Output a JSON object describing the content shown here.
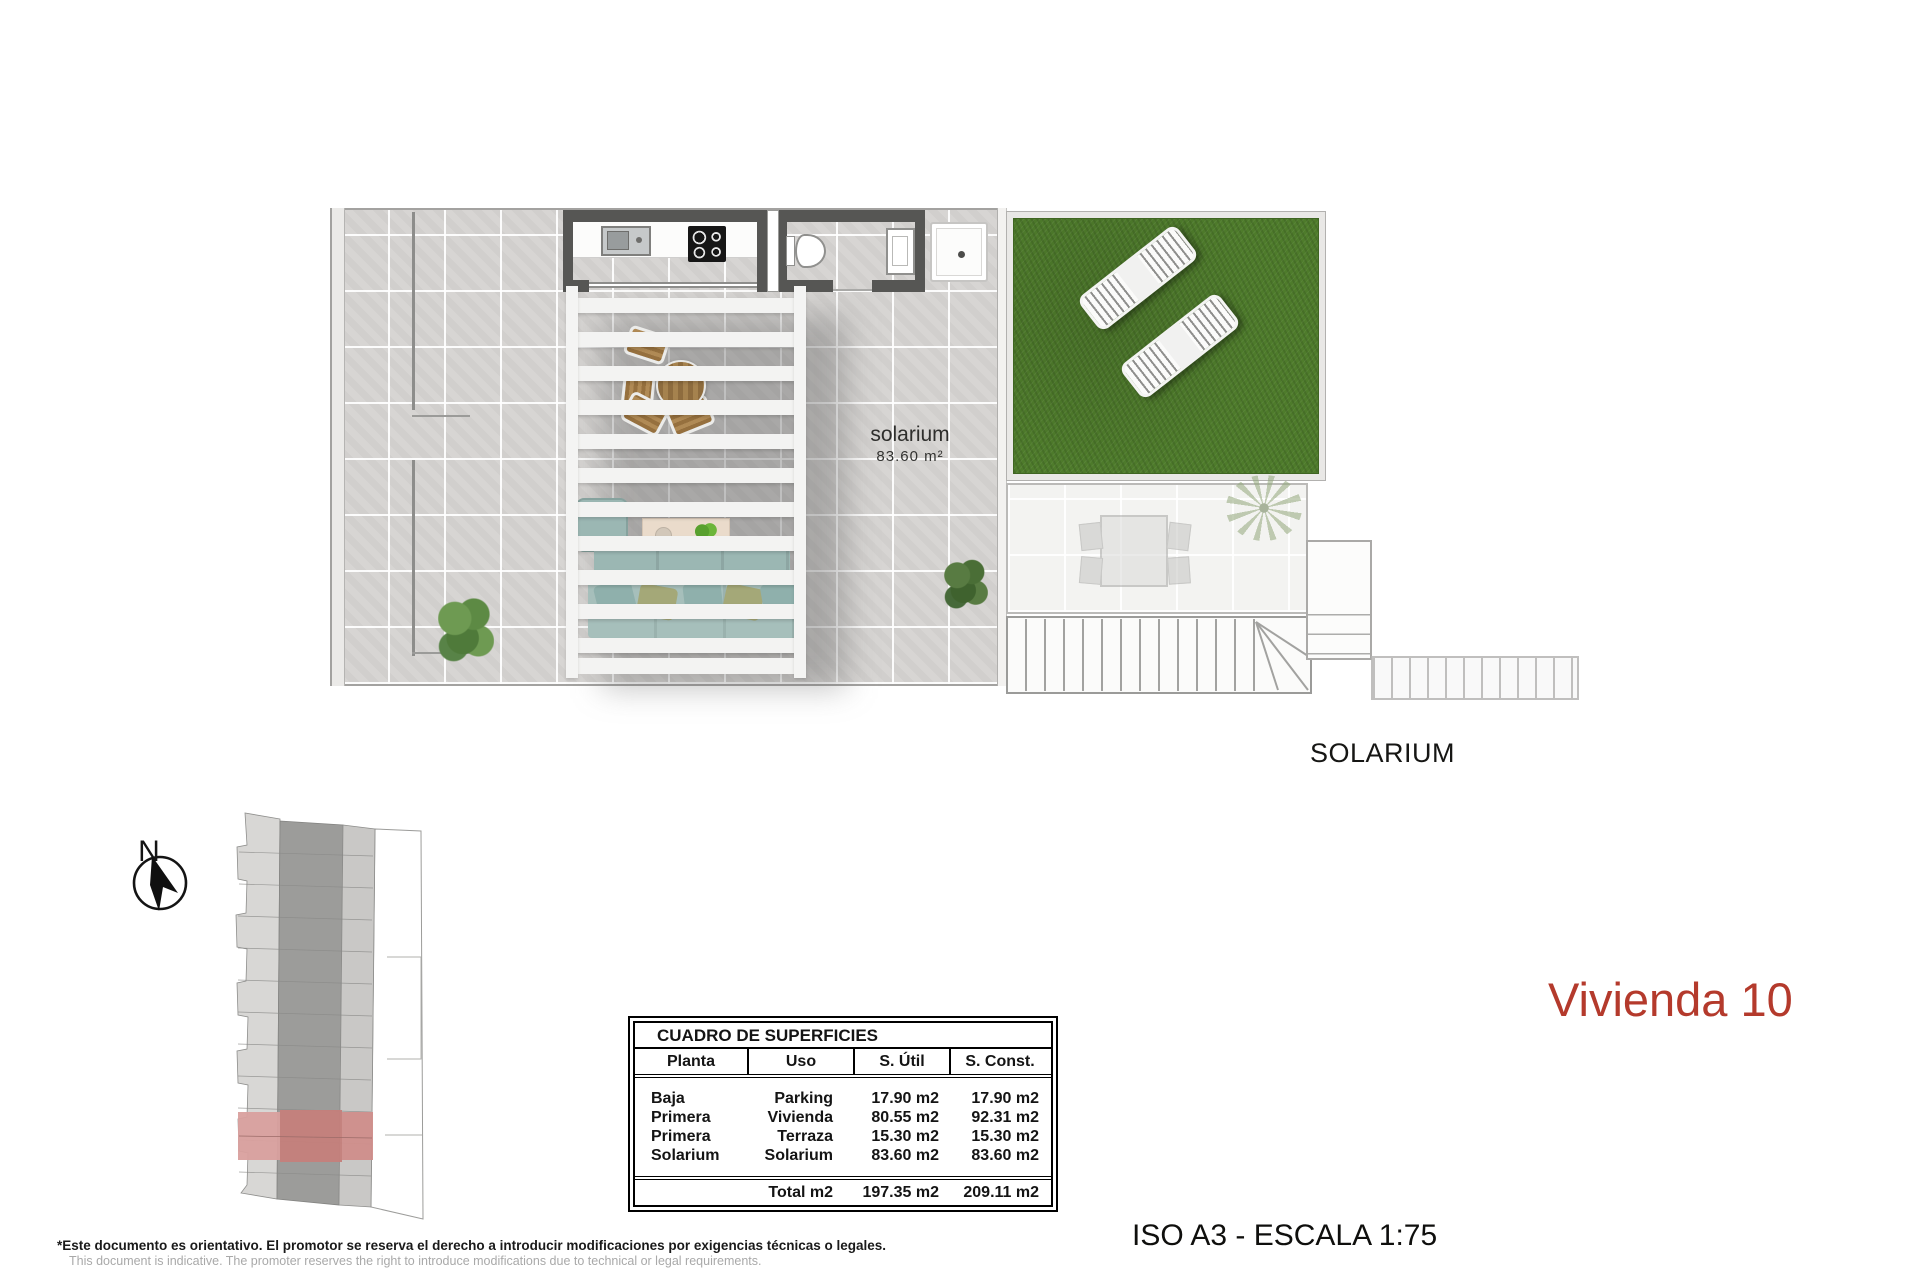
{
  "plan": {
    "room_label": "solarium",
    "room_area": "83.60 m²"
  },
  "titles": {
    "floor_name": "SOLARIUM",
    "unit_title": "Vivienda 10",
    "format_scale": "ISO A3 - ESCALA 1:75"
  },
  "compass": {
    "north_label": "N"
  },
  "table": {
    "title": "CUADRO DE SUPERFICIES",
    "headers": [
      "Planta",
      "Uso",
      "S. Útil",
      "S. Const."
    ],
    "rows": [
      [
        "Baja",
        "Parking",
        "17.90 m2",
        "17.90 m2"
      ],
      [
        "Primera",
        "Vivienda",
        "80.55 m2",
        "92.31 m2"
      ],
      [
        "Primera",
        "Terraza",
        "15.30 m2",
        "15.30 m2"
      ],
      [
        "Solarium",
        "Solarium",
        "83.60 m2",
        "83.60 m2"
      ]
    ],
    "total": {
      "label": "Total m2",
      "util": "197.35 m2",
      "const": "209.11 m2"
    }
  },
  "disclaimer": {
    "es": "*Este documento es orientativo. El promotor se reserva el derecho a introducir modificaciones por exigencias técnicas o legales.",
    "en": "This document is indicative. The promoter reserves the right to introduce modifications due to technical or legal requirements."
  },
  "colors": {
    "accent_red": "#b43a2c",
    "grass_green": "#4e7b2b",
    "unit_highlight": "#c57f7b"
  }
}
